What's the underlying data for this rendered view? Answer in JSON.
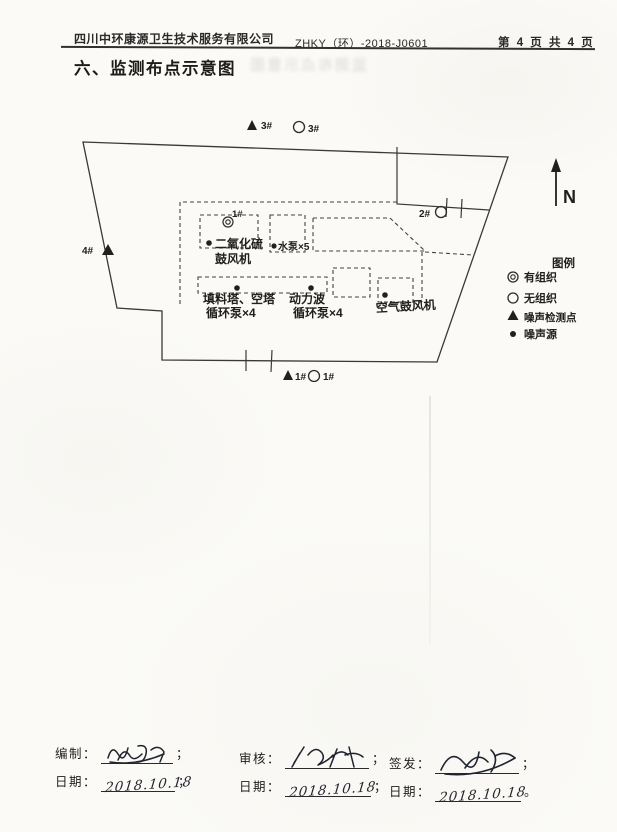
{
  "header": {
    "company": "四川中环康源卫生技术服务有限公司",
    "doc_number": "ZHKY（环）-2018-J0601",
    "page_info": "第 4 页 共 4 页"
  },
  "title": "六、监测布点示意图",
  "diagram": {
    "north_label": "N",
    "legend": {
      "title": "图例",
      "items": [
        {
          "symbol": "double-circle",
          "label": "有组织"
        },
        {
          "symbol": "circle",
          "label": "无组织"
        },
        {
          "symbol": "triangle",
          "label": "噪声检测点"
        },
        {
          "symbol": "dot",
          "label": "噪声源"
        }
      ]
    },
    "markers": {
      "noise3": "3#",
      "gas3": "3#",
      "gas2": "2#",
      "noise4": "4#",
      "noise1": "1#",
      "gas1": "1#",
      "stack1": "1#"
    },
    "equipment": {
      "so2_blower": [
        "二氧化硫",
        "鼓风机"
      ],
      "water_pump": "水泵×5",
      "packing_tower": [
        "填料塔、空塔",
        "循环泵×4"
      ],
      "dynamic_wave": [
        "动力波",
        "循环泵×4"
      ],
      "air_blower": "空气鼓风机"
    }
  },
  "footer": {
    "blocks": [
      {
        "role": "编制：",
        "sep_role": "；",
        "date_label": "日期：",
        "date": "2018.10.18",
        "sep_date": "；"
      },
      {
        "role": "审核：",
        "sep_role": "；",
        "date_label": "日期：",
        "date": "2018.10.18",
        "sep_date": "；"
      },
      {
        "role": "签发：",
        "sep_role": "；",
        "date_label": "日期：",
        "date": "2018.10.18",
        "sep_date": "。"
      }
    ]
  }
}
